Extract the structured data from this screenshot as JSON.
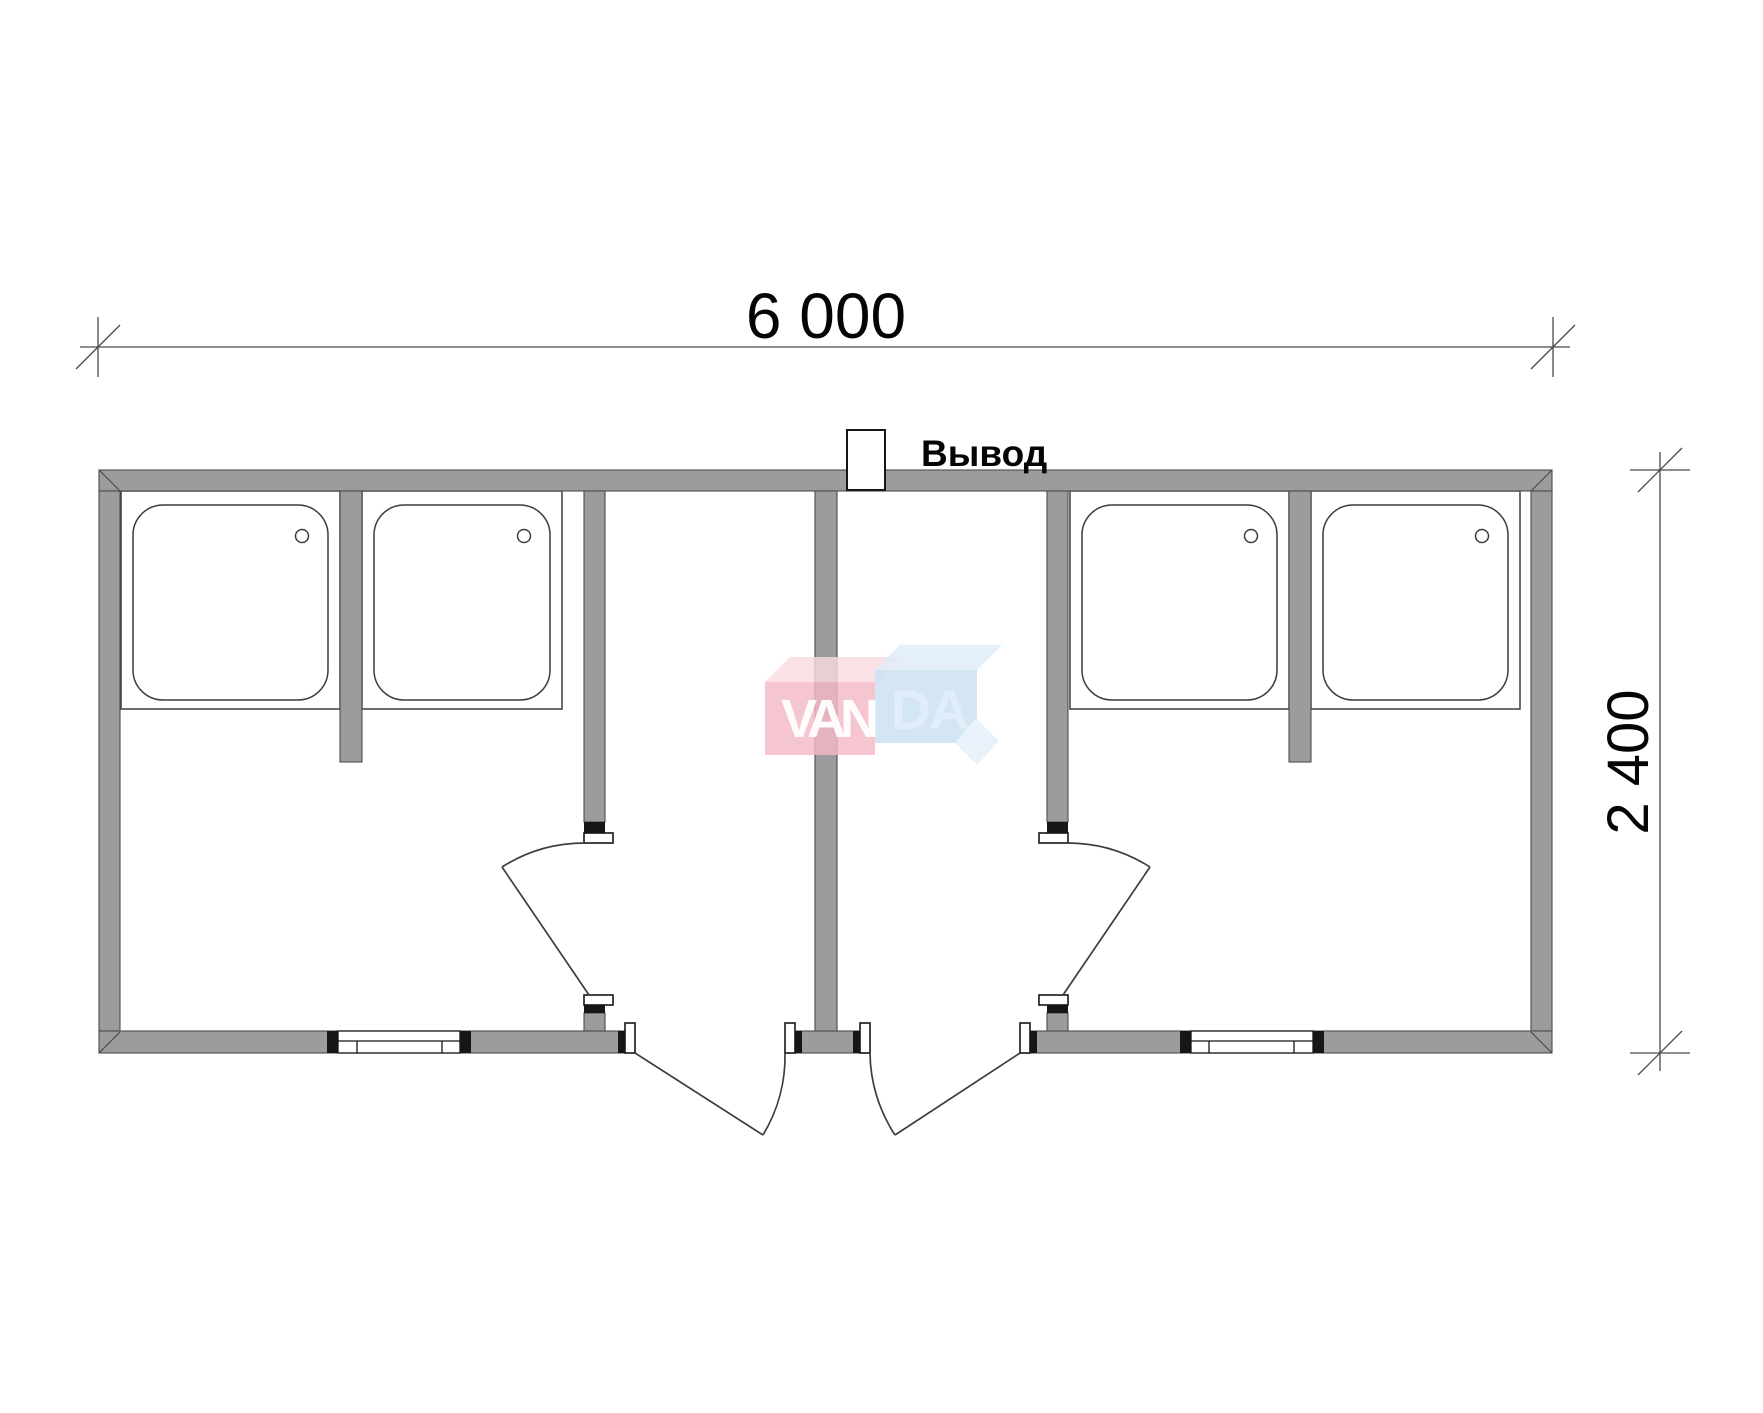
{
  "dimensions": {
    "width_label": "6 000",
    "height_label": "2 400"
  },
  "labels": {
    "outlet": "Вывод"
  },
  "watermark": {
    "text": "VANDA",
    "left_part": "VAN",
    "right_part": "DA"
  },
  "plan": {
    "type": "floor-plan",
    "shower_trays": 4,
    "interior_doors": 2,
    "entrance_doors": 2,
    "windows": 2,
    "utility_outlets": 1
  },
  "colors": {
    "wall": "#9c9c9c",
    "line": "#3d3d3d",
    "watermark_pink_front": "#f4bac6",
    "watermark_pink_top": "#f9dae0",
    "watermark_blue_front": "#cadff2",
    "watermark_blue_top": "#dfecf8",
    "watermark_letter_left": "#ffffff",
    "watermark_letter_right": "#e2edf8"
  }
}
